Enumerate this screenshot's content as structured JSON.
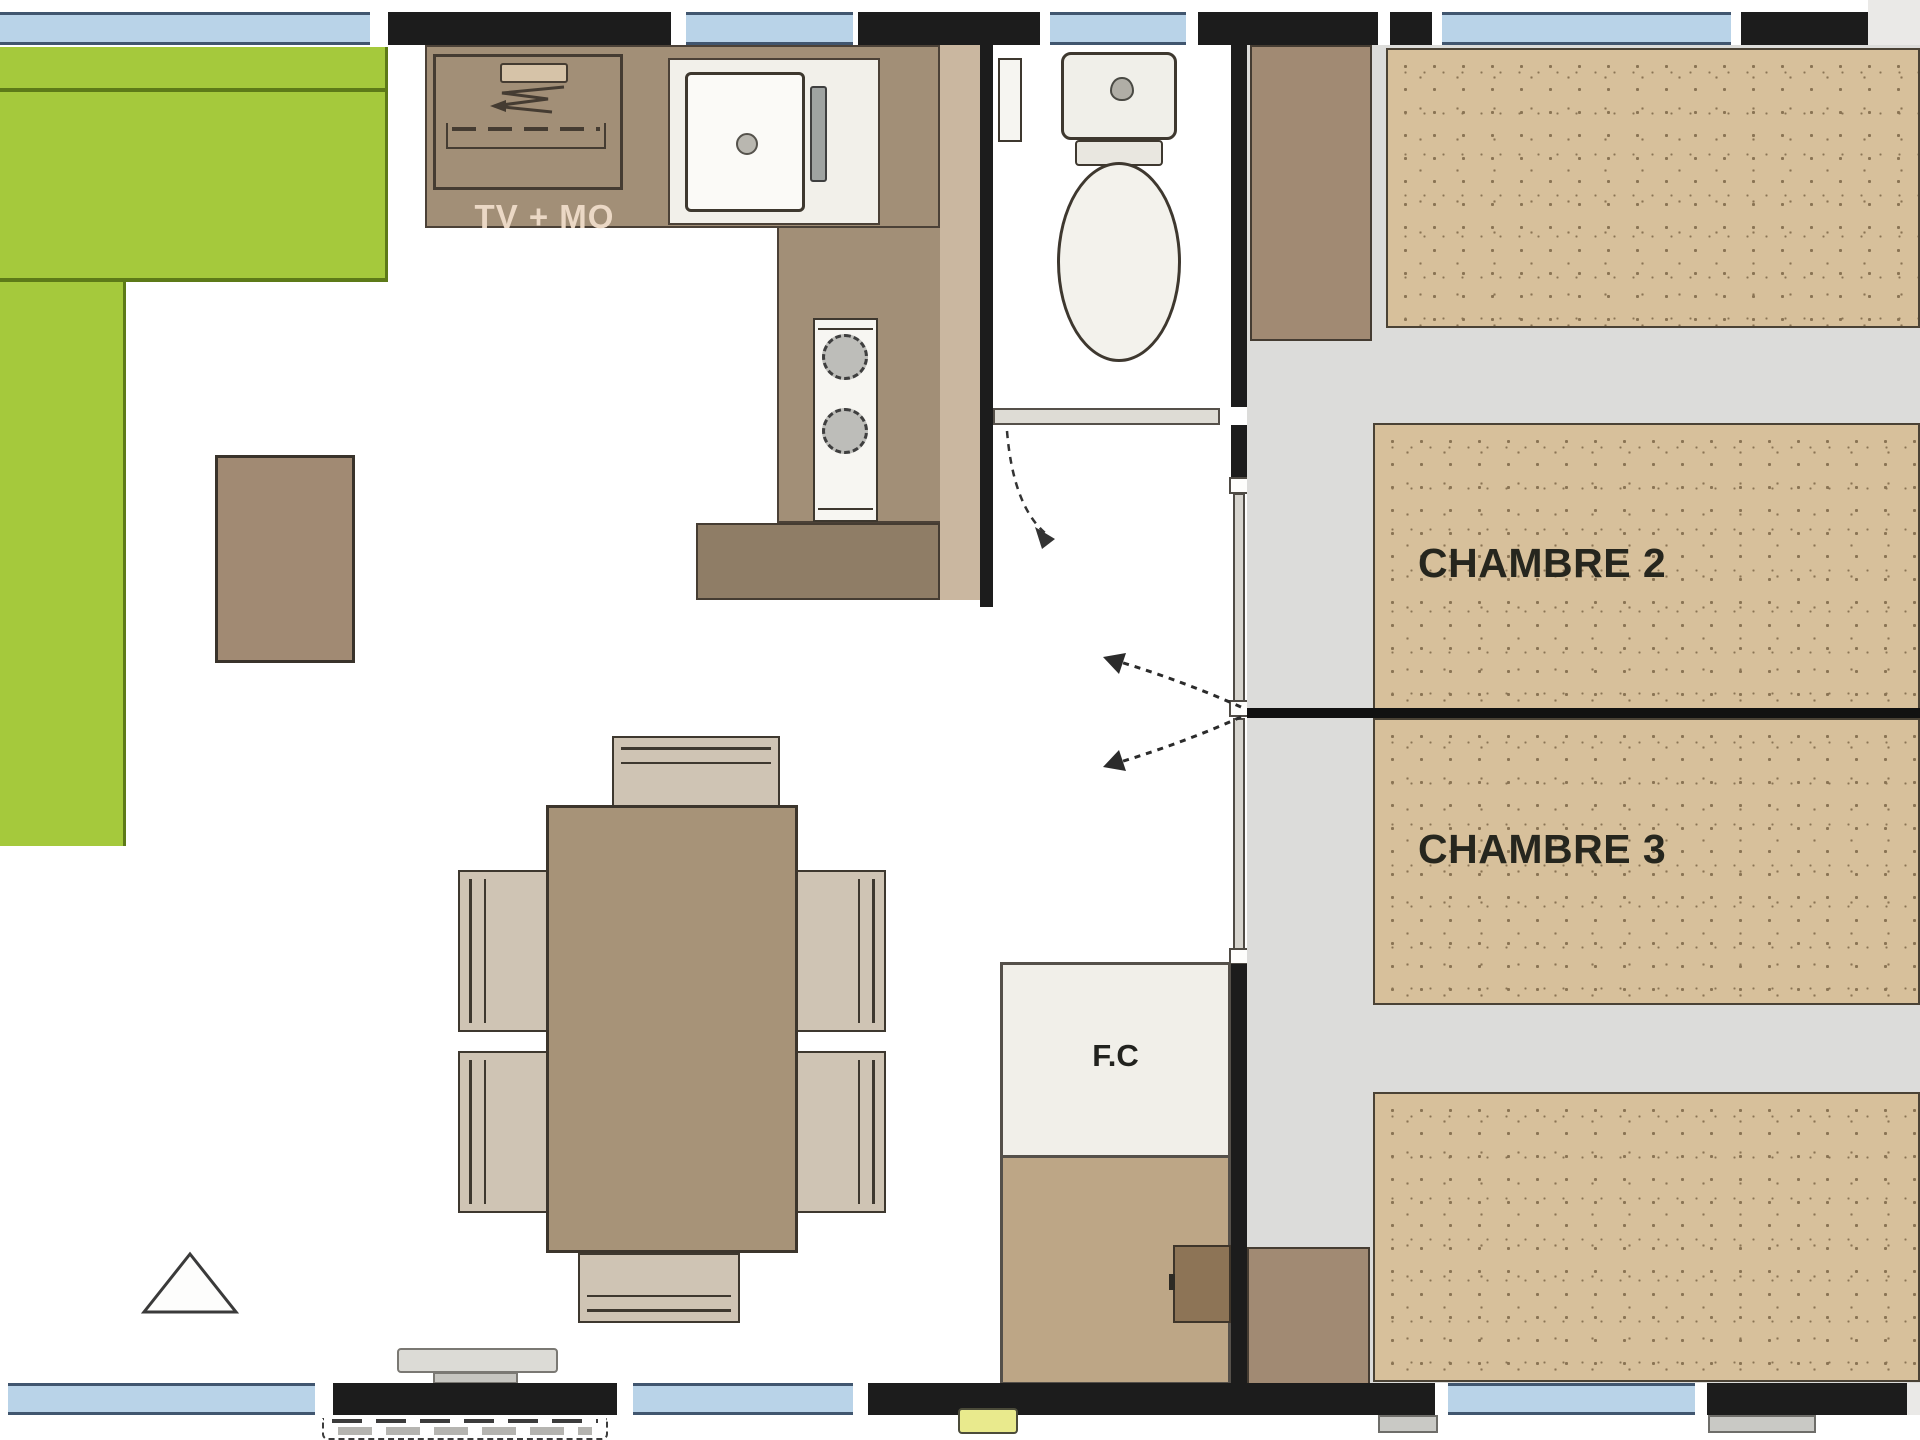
{
  "plan": {
    "name": "mobile-home-floor-plan",
    "labels": {
      "tv_unit": "TV + MO",
      "bedroom2": "CHAMBRE 2",
      "bedroom3": "CHAMBRE 3",
      "closet": "F.C"
    },
    "symbols": [
      "toilet",
      "sink",
      "stove-burners",
      "tv-zigzag",
      "wc-door-swing-arc",
      "sliding-door-arrows",
      "entry-step",
      "step-dashes",
      "ventilation-triangle"
    ],
    "colors": {
      "wall": "#1c1c1c",
      "window": "#b9d3e8",
      "window-frame": "#41566f",
      "sofa": "#a5c93c",
      "sofa-line": "#5d7a18",
      "counter": "#a28f77",
      "counter-light": "#cab7a0",
      "counter-dark": "#8f7d66",
      "unit-white": "#f2f0ea",
      "basin": "#fbfaf7",
      "floor": "#dcdcda",
      "bed": "#d7c09b",
      "bed-dot": "#8a7454",
      "wood": "#a18a73",
      "table": "#a79378",
      "chair": "#cfc4b4",
      "outline": "#3e382f",
      "door-gray": "#dedcd5",
      "track": "#d7d5cf",
      "label-dark": "#26261e",
      "tv-label": "#ebd8c5",
      "yellow": "#e9ea8d",
      "step": "#dcdbd6",
      "step-dark": "#c6c5c0",
      "foot": "#c9c9c5",
      "corner": "#eae9e7",
      "fc-brown": "#bda686",
      "fc-door": "#8d7456"
    }
  }
}
